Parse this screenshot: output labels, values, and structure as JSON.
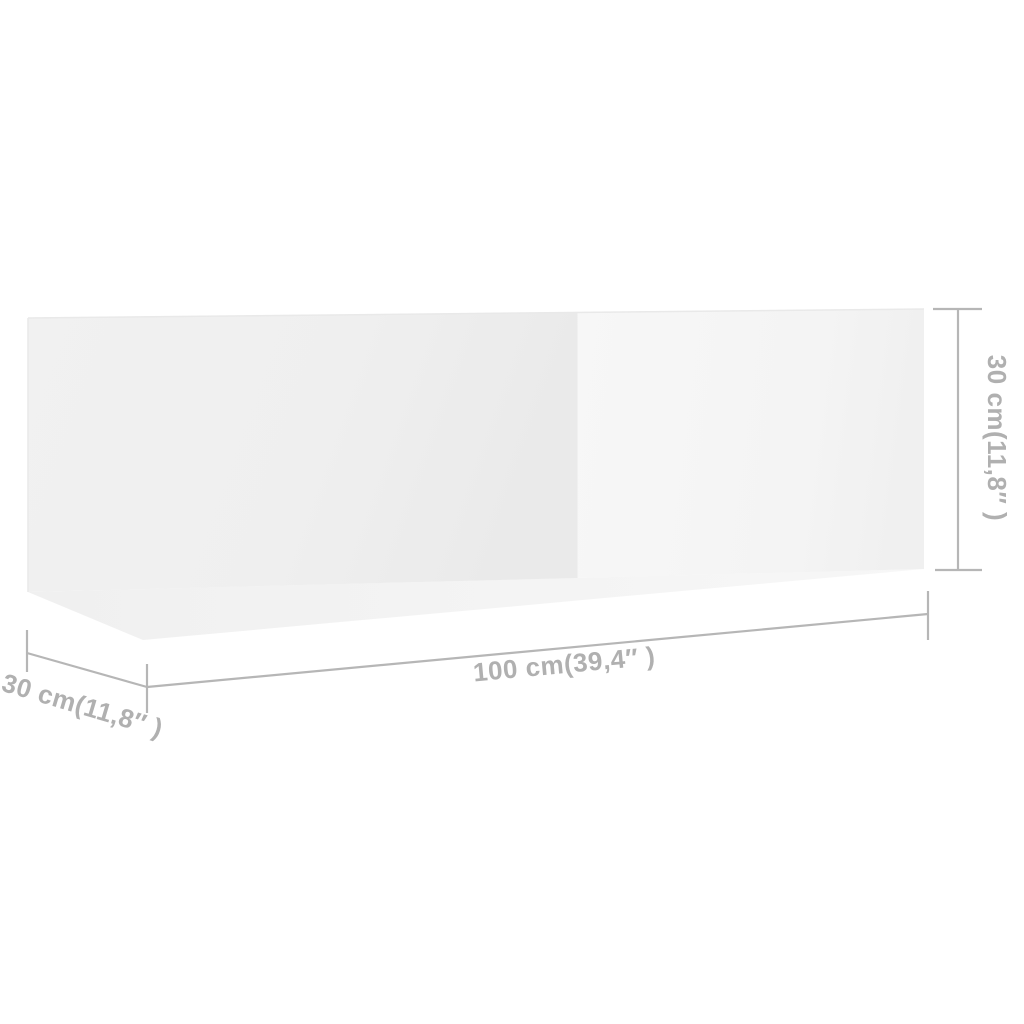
{
  "figure": {
    "type": "product-dimension-diagram",
    "object": "wall-mounted-tv-cabinet",
    "door_count": 2
  },
  "dimensions": {
    "width_label": "100 cm(39,4″ )",
    "depth_label": "30 cm(11,8″ )",
    "height_label": "30 cm(11,8″ )"
  },
  "colors": {
    "background": "#ffffff",
    "dimension_line": "#b6b6b6",
    "dimension_text": "#b0b0b0",
    "cabinet_face_left": "#efefef",
    "cabinet_face_right": "#f5f5f5",
    "cabinet_bottom_face": "#f4f4f4",
    "cabinet_seam": "#d8d8d8",
    "cabinet_edge": "#e9e9e9"
  }
}
